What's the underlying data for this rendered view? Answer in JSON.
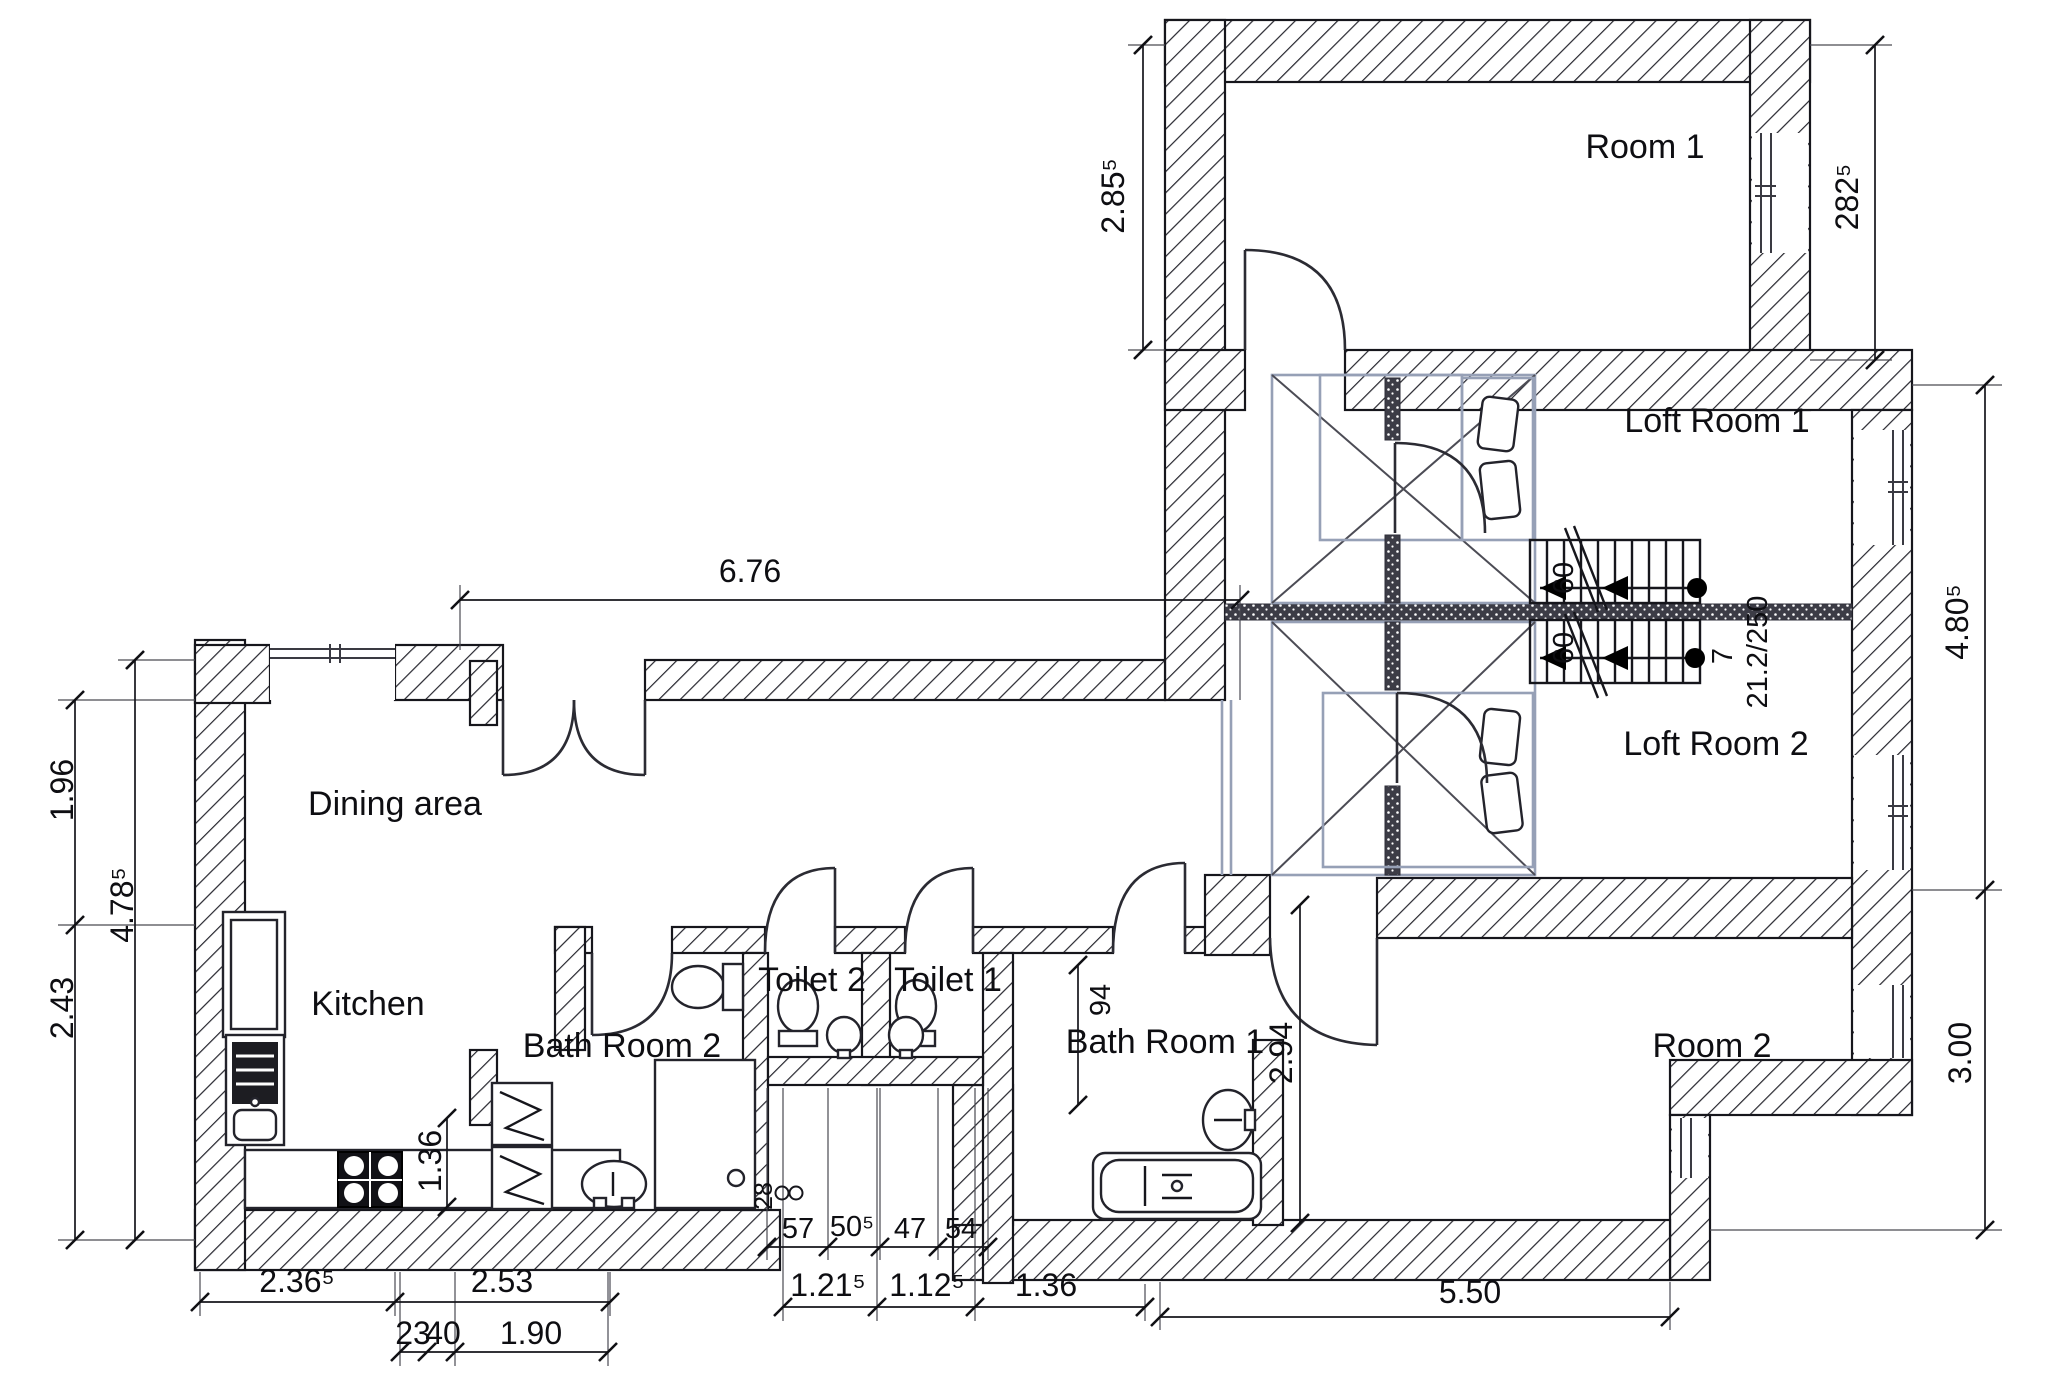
{
  "labels": {
    "room1": "Room 1",
    "loft_room1": "Loft Room 1",
    "loft_room2": "Loft Room 2",
    "room2": "Room 2",
    "dining": "Dining area",
    "kitchen": "Kitchen",
    "bath2": "Bath Room 2",
    "toilet2": "Toilet 2",
    "toilet1": "Toilet 1",
    "bath1": "Bath Room 1"
  },
  "dims": {
    "corridor_top": "6.76",
    "room1_left": "2.85⁵",
    "room1_right": "282⁵",
    "loft_right": "4.80⁵",
    "room2_right": "3.00",
    "left_upper": "1.96",
    "left_total": "4.78⁵",
    "left_lower": "2.43",
    "kitchen_counter": "1.36",
    "bath1_inner": "94",
    "room2_west": "2.94",
    "corridor_stub": "28",
    "bottom_kitchen": "2.36⁵",
    "bottom_bath2": "2.53",
    "bottom_sub_a": "23",
    "bottom_sub_b": "40",
    "bottom_sub_c": "1.90",
    "bottom_toilet2": "1.21⁵",
    "bottom_toilet1": "1.12⁵",
    "bottom_bath1": "1.36",
    "bottom_room2": "5.50",
    "small_a": "57",
    "small_b": "50⁵",
    "small_c": "47",
    "small_d": "54"
  },
  "stairs": {
    "width_upper": "60",
    "width_lower": "60",
    "count": "7",
    "pitch": "21.2/250"
  }
}
